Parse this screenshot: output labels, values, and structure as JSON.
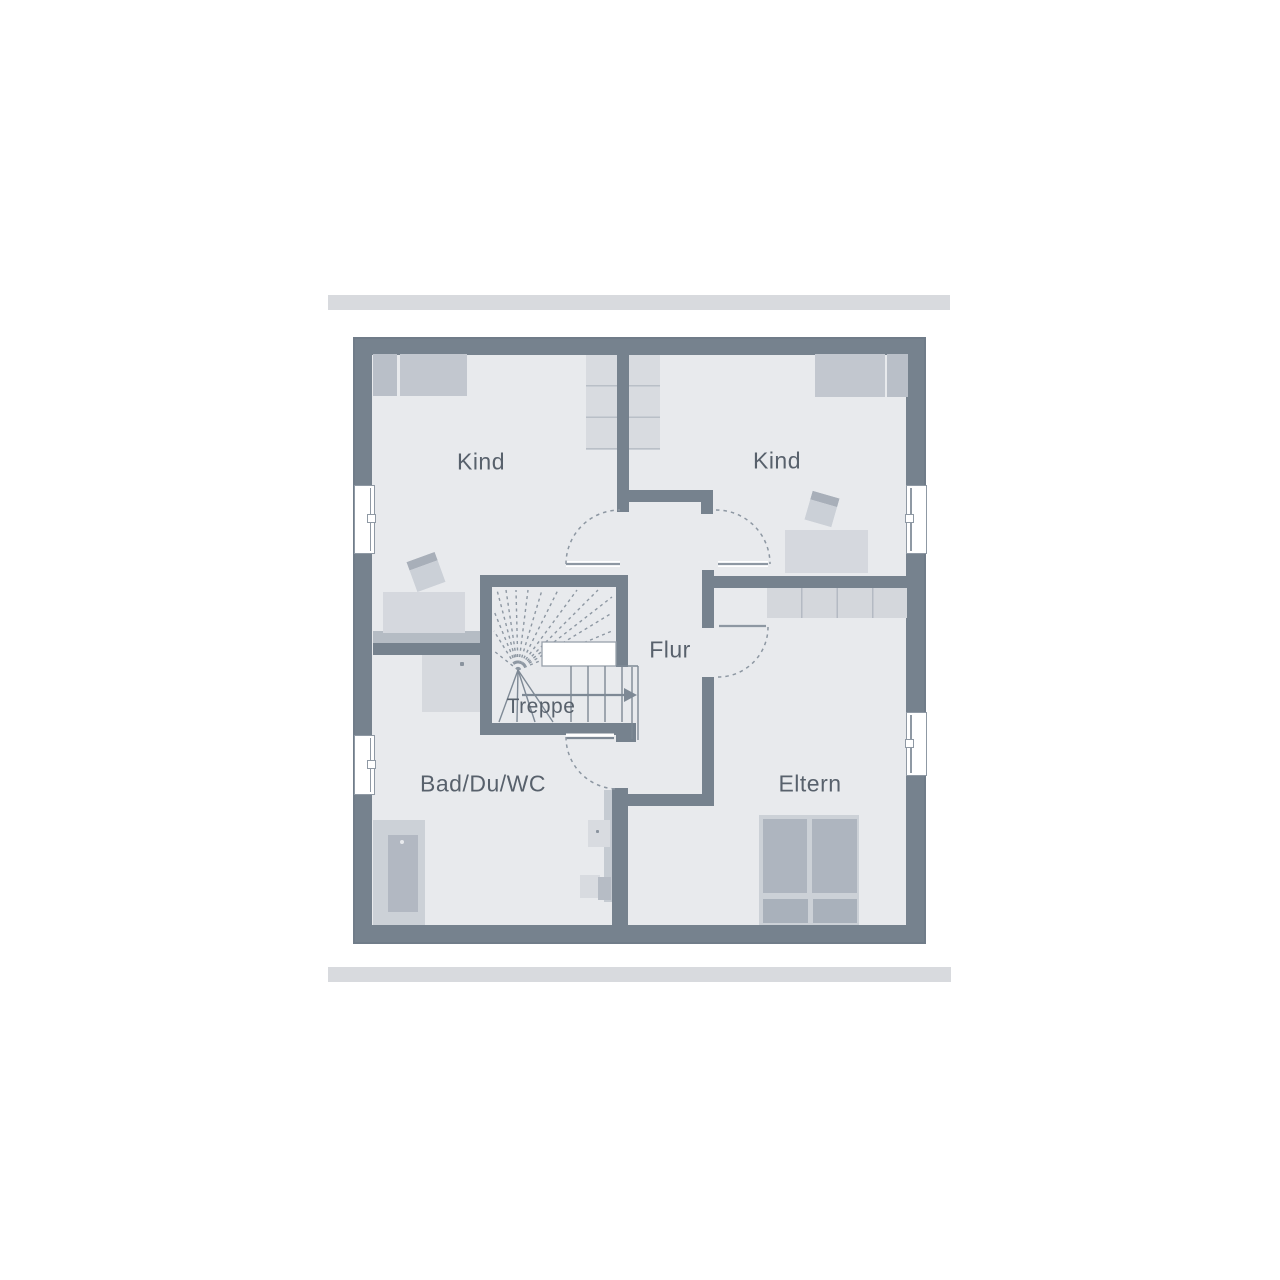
{
  "plan": {
    "title_hint": "upper floor plan",
    "rooms": {
      "kind_left": {
        "label": "Kind"
      },
      "kind_right": {
        "label": "Kind"
      },
      "flur": {
        "label": "Flur"
      },
      "treppe": {
        "label": "Treppe"
      },
      "bad_du_wc": {
        "label": "Bad/Du/WC"
      },
      "eltern": {
        "label": "Eltern"
      }
    },
    "colors": {
      "wall": "#76828E",
      "floor": "#E8EAED",
      "furniture_light": "#D5D8DE",
      "furniture_medium": "#C2C7CF",
      "furniture_dark": "#AFB5BF",
      "line_accent": "#8D97A2",
      "label_text": "#58616C",
      "roof_edge": "#D8DADE",
      "stair_landing": "#FFFFFF"
    },
    "icons": {
      "windows": "window-icon",
      "doors": "door-swing-arc",
      "stairs": "staircase",
      "stair_direction": "arrow-right-icon"
    }
  }
}
